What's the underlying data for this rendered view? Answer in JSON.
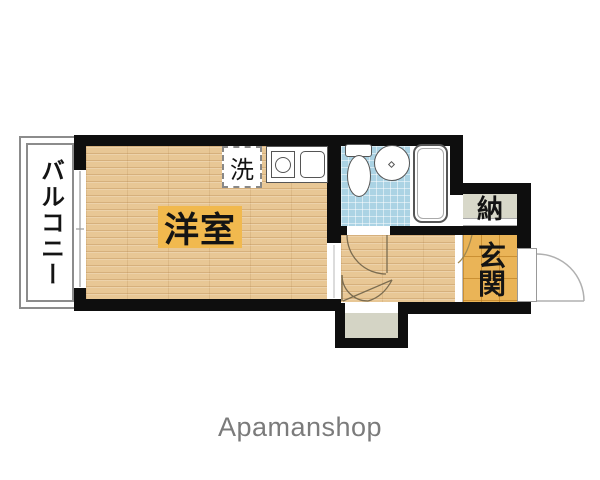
{
  "floorplan": {
    "labels": {
      "balcony": "バルコニー",
      "room": "洋室",
      "laundry": "洗",
      "storage": "納",
      "entrance": "玄関"
    },
    "colors": {
      "wall": "#0e0e0e",
      "wood_floor": "#e8c795",
      "room_label_bg": "#f1b94e",
      "bathroom_tile": "#abd3e4",
      "entrance_tile": "#eab457",
      "storage_fill": "#d8d8c9",
      "utility_fill": "#d4d4c5",
      "fixture_stroke": "#555555",
      "door_arc": "#7b6c50"
    },
    "icons": {
      "toilet-icon": "css-shape",
      "wash-basin-icon": "css-shape",
      "bathtub-icon": "css-shape",
      "stove-burner-icon": "css-shape",
      "kitchen-sink-icon": "css-shape",
      "door-swing-icon": "svg-arc",
      "window-icon": "svg-line"
    }
  },
  "footer": {
    "brand": "Apamanshop"
  }
}
